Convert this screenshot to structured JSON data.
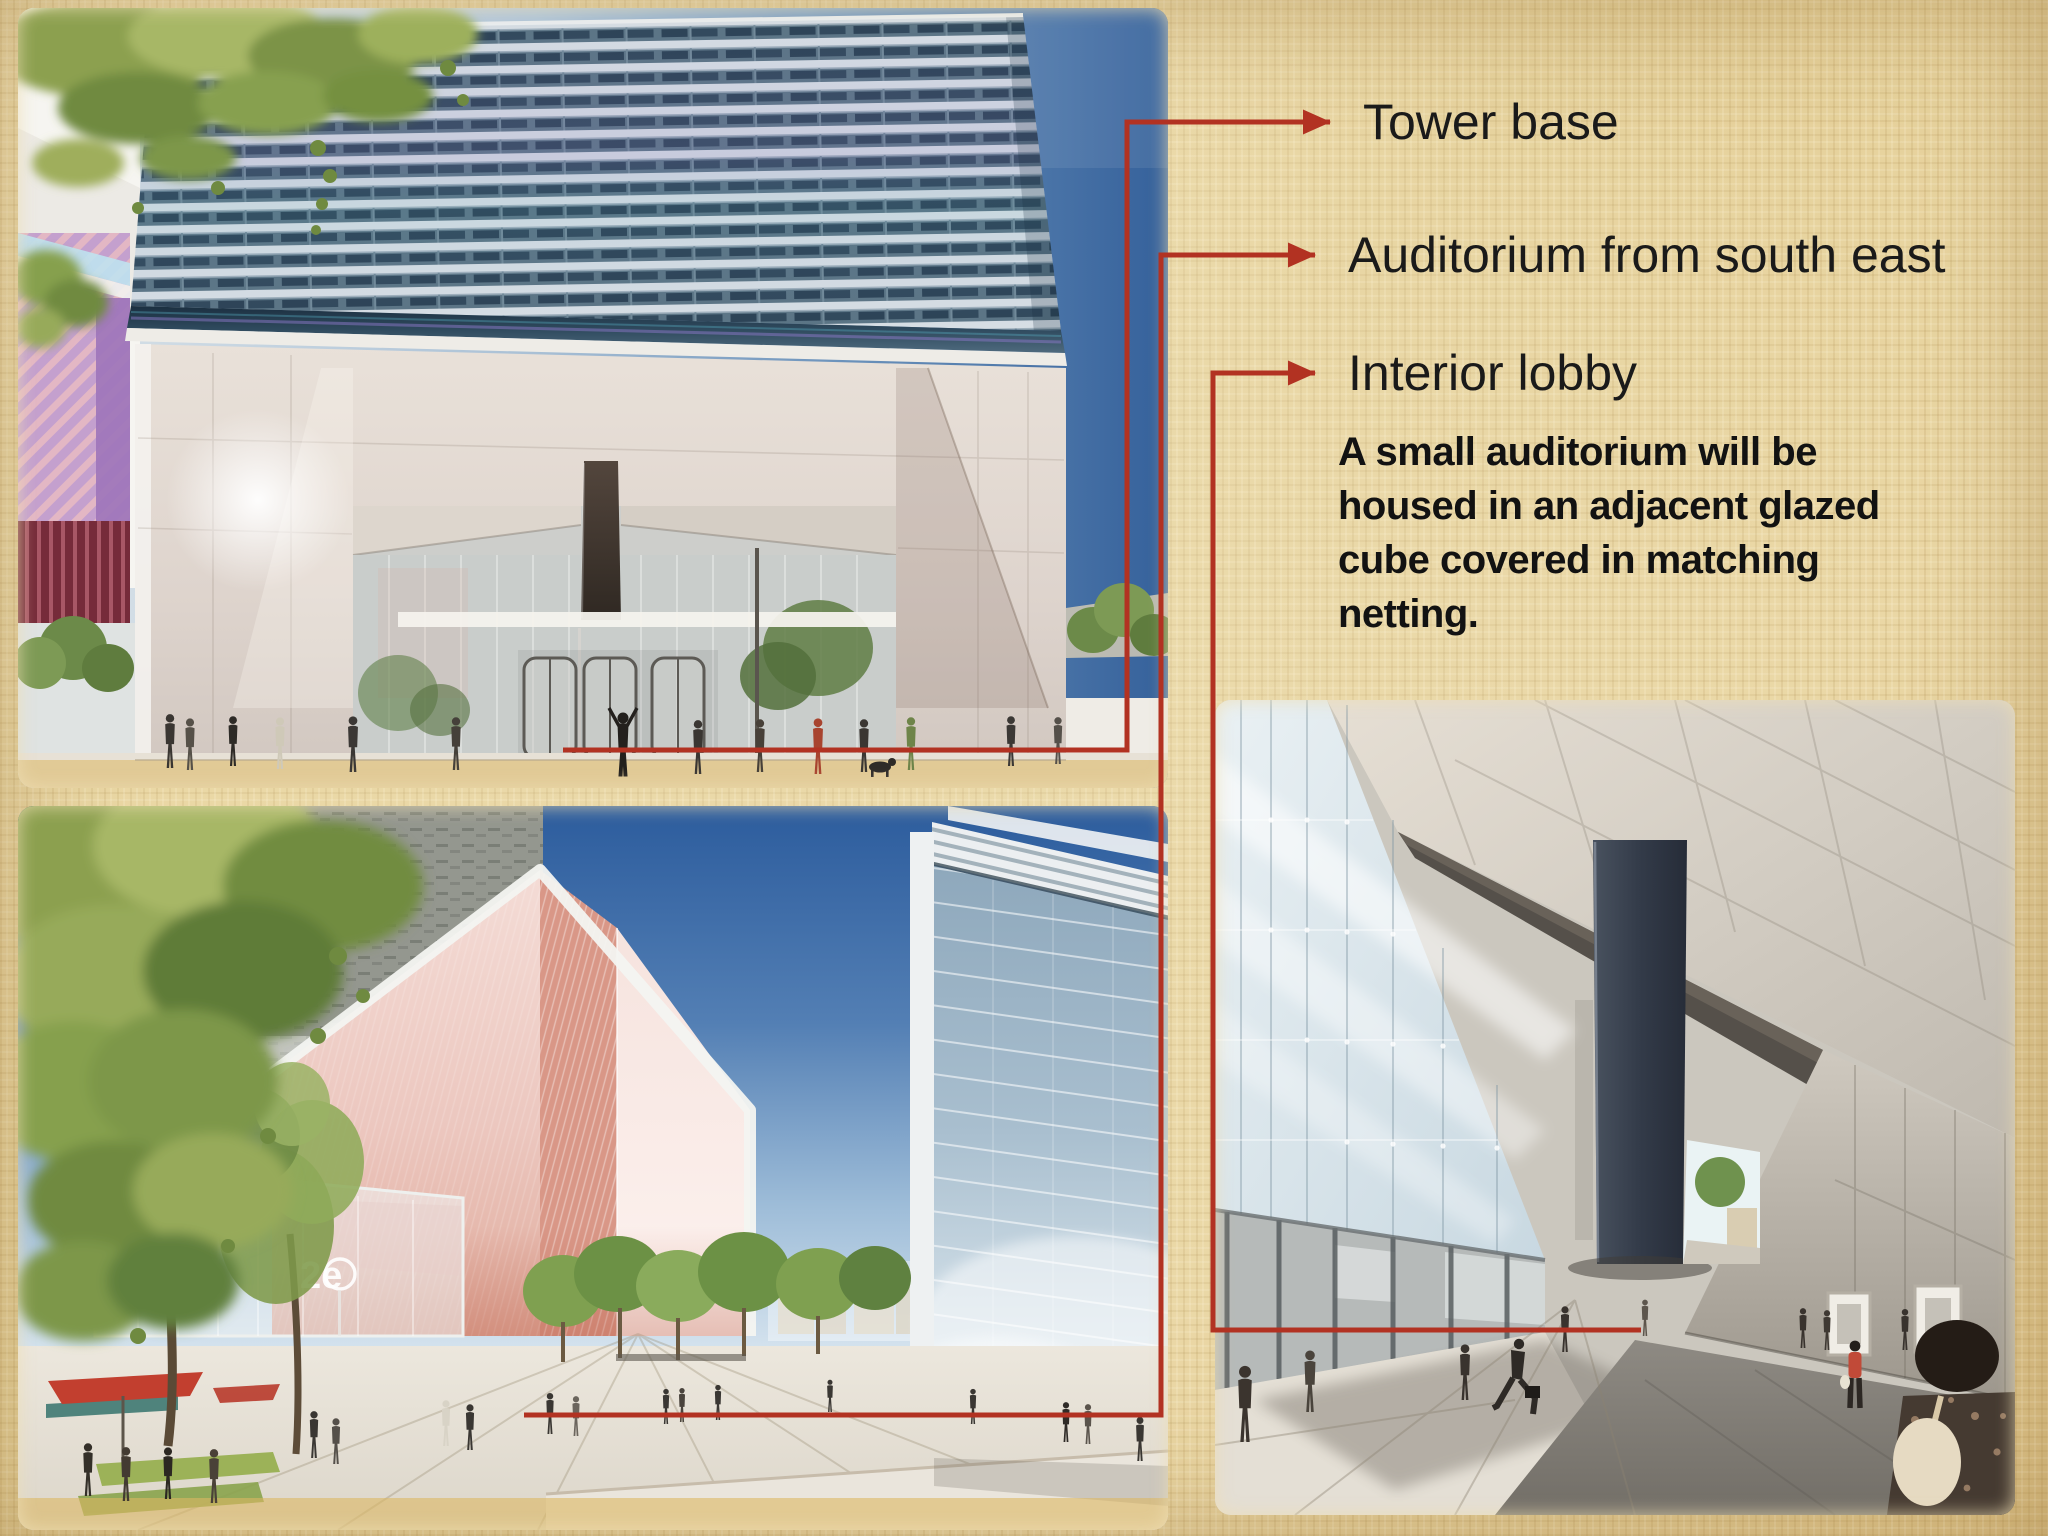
{
  "colors": {
    "background": "#e7d3a0",
    "accent_red": "#b23222",
    "label_text": "#1a1a1a",
    "body_text": "#121212"
  },
  "callouts": {
    "tower_base": {
      "label": "Tower base"
    },
    "auditorium": {
      "label": "Auditorium from south east"
    },
    "interior_lobby": {
      "label": "Interior lobby"
    }
  },
  "annotation": {
    "body_lines": [
      "A small auditorium will be",
      "housed in an adjacent glazed",
      "cube covered in matching",
      "netting."
    ]
  },
  "images": {
    "tower_base": {
      "description": "Rendering of the tower base: louvered facade above a tall glass lobby with people on the plaza"
    },
    "auditorium": {
      "description": "Rendering of the glazed auditorium cube covered in netting, seen from the south east",
      "logo_text": "2e"
    },
    "interior_lobby": {
      "description": "Rendering of the interior lobby with angled stone ceiling, glass wall and visitors"
    }
  }
}
